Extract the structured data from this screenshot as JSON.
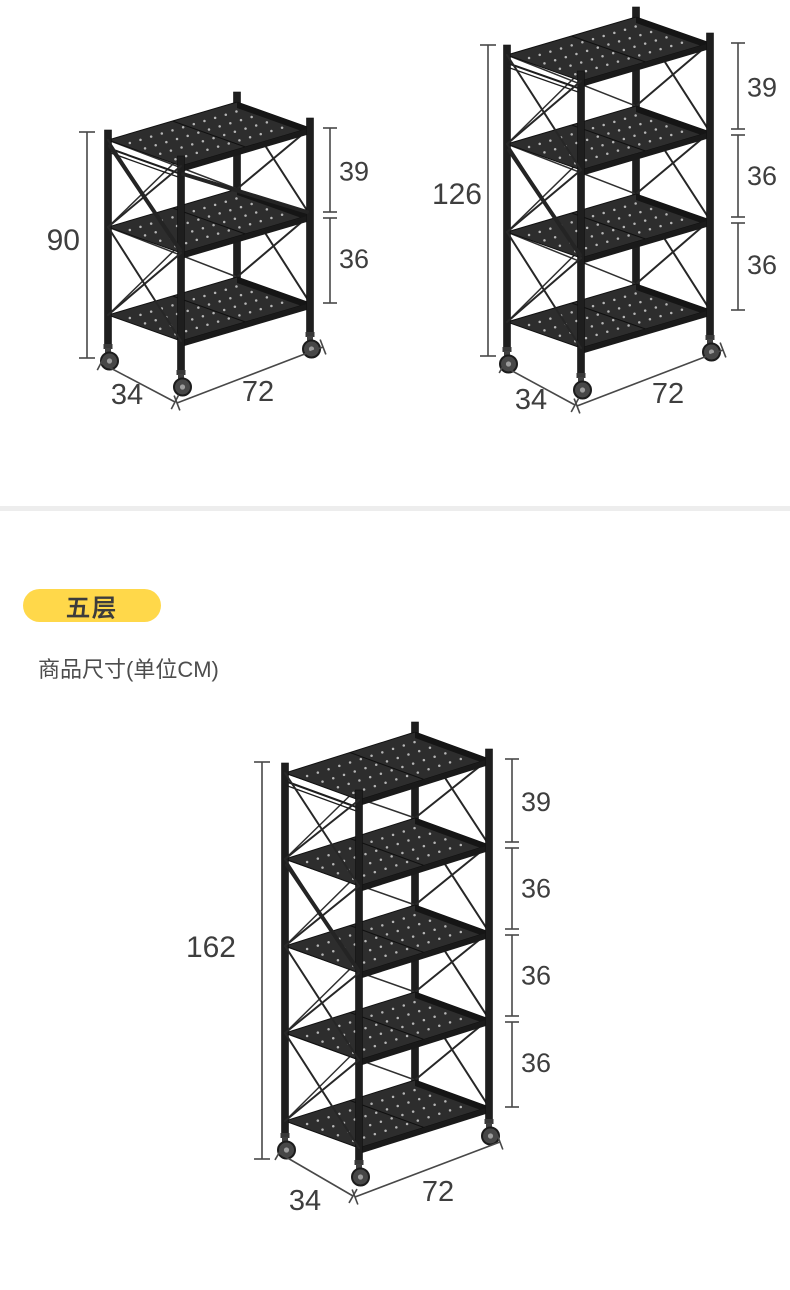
{
  "section": {
    "badge_label": "五层",
    "caption": "商品尺寸(单位CM)"
  },
  "racks": [
    {
      "name": "three-tier",
      "tiers": 3,
      "height_cm": "90",
      "gaps_cm": [
        "39",
        "36"
      ],
      "depth_cm": "34",
      "width_cm": "72"
    },
    {
      "name": "four-tier",
      "tiers": 4,
      "height_cm": "126",
      "gaps_cm": [
        "39",
        "36",
        "36"
      ],
      "depth_cm": "34",
      "width_cm": "72"
    },
    {
      "name": "five-tier",
      "tiers": 5,
      "height_cm": "162",
      "gaps_cm": [
        "39",
        "36",
        "36",
        "36"
      ],
      "depth_cm": "34",
      "width_cm": "72"
    }
  ],
  "colors": {
    "background": "#ffffff",
    "divider": "#ededed",
    "badge_bg": "#ffd84a",
    "badge_text": "#3c3c3c",
    "caption_text": "#4d4d4d",
    "dimension_text": "#3e3e3e",
    "dimension_line": "#484848",
    "rack_metal": "#1e1e1e",
    "shelf_top": "#2d2d2d",
    "perforation": "#cfcfcf"
  }
}
